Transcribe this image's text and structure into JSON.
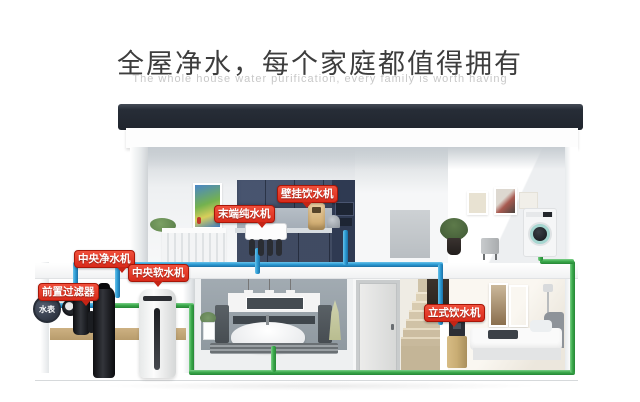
{
  "header": {
    "title": "全屋净水，每个家庭都值得拥有",
    "subtitle": "The whole house water purification, every family is worth having"
  },
  "labels": {
    "wall_dispenser": "壁挂饮水机",
    "terminal_purifier": "末端纯水机",
    "central_purifier": "中央净水机",
    "central_softener": "中央软水机",
    "pre_filter": "前置过滤器",
    "water_meter": "水表",
    "standing_dispenser": "立式饮水机"
  },
  "colors": {
    "pipe_cold": "#2e9ed6",
    "pipe_soft": "#3cab4d",
    "label_bg": "#d92a1a",
    "roof": "#272d37",
    "cabinet_navy": "#3d4a66"
  }
}
